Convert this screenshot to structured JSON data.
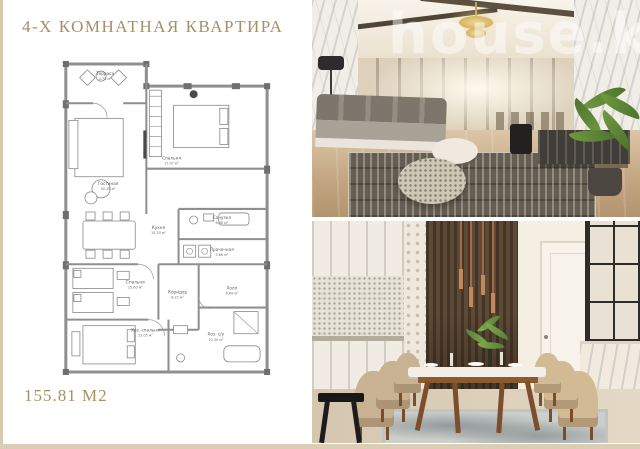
{
  "page": {
    "title": "4-Х КОМНАТНАЯ КВАРТИРА",
    "area_label": "155.81 М2",
    "accent_color": "#a98e63"
  },
  "floor_plan": {
    "rooms": [
      {
        "name": "Терраса",
        "area": "4.79 м²"
      },
      {
        "name": "Гостиная",
        "area": "30.28 м²"
      },
      {
        "name": "Спальня",
        "area": "17.07 м²"
      },
      {
        "name": "Кухня",
        "area": "15.20 м²"
      },
      {
        "name": "Санузел",
        "area": "6.68 м²"
      },
      {
        "name": "Прачечная",
        "area": "5.66 м²"
      },
      {
        "name": "Спальня",
        "area": "15.60 м²"
      },
      {
        "name": "Коридор",
        "area": "8.22 м²"
      },
      {
        "name": "Холл",
        "area": "6.84 м²"
      },
      {
        "name": "Хоз. спальня",
        "area": "23.05 м²"
      },
      {
        "name": "Хоз. с/у",
        "area": "10.30 м²"
      }
    ]
  },
  "photos": {
    "watermark": "house.kg"
  }
}
